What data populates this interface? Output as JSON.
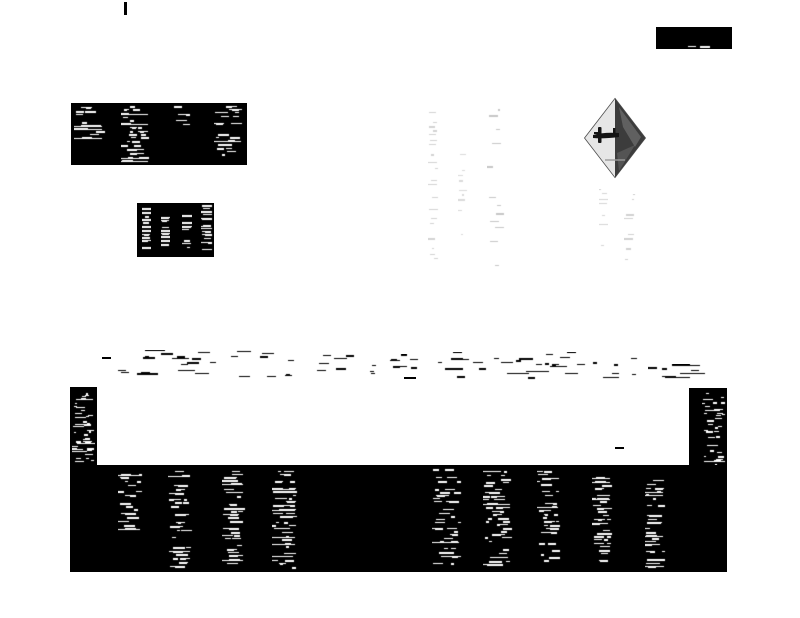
{
  "document": {
    "type": "scanned microfilm newspaper page",
    "condition": "heavily degraded high-contrast binarized scan",
    "legibility": "all body text illegible (reduced to speckle fragments)",
    "orientation_note": "most text blocks are rotated 90 degrees (sideways column text)"
  },
  "colors": {
    "ink": "#000000",
    "paper": "#ffffff",
    "faint_ink": "#c9c9c9",
    "logo_border": "#4a4a4a",
    "logo_left_fill": "#e6e6e6",
    "logo_right_fill": "#3c3c3c",
    "logo_plane": "#141414"
  },
  "header": {
    "corner_fragment": {
      "description": "small solid ink blob with broken white character traces",
      "legible": false
    }
  },
  "masthead_box": {
    "description": "solid black box, four vertical columns of eroded white text",
    "text_columns": 4,
    "legible": false
  },
  "notice_box": {
    "description": "small solid black box with four short vertical lines of white text",
    "text_lines": 4,
    "legible": false
  },
  "watermark": {
    "description": "extremely faint gray vertical text columns showing through the page",
    "columns": 3,
    "legible": false
  },
  "logo": {
    "shape": "diamond",
    "symbol": "airplane silhouette, light left half and dark right half",
    "legible": false
  },
  "caption": {
    "description": "two faint vertical text fragments below the diamond emblem",
    "fragments": 2,
    "legible": false
  },
  "byline_band": {
    "description": "scattered horizontal black dash fragments of two eroded text lines",
    "fragment_clusters": 4,
    "legible": false
  },
  "advertisement_block": {
    "description": "large black advertisement with white interior notch; sideways white text",
    "left_margin_lines": 14,
    "right_margin_lines": 12,
    "text_columns": 9,
    "legible": false
  }
}
